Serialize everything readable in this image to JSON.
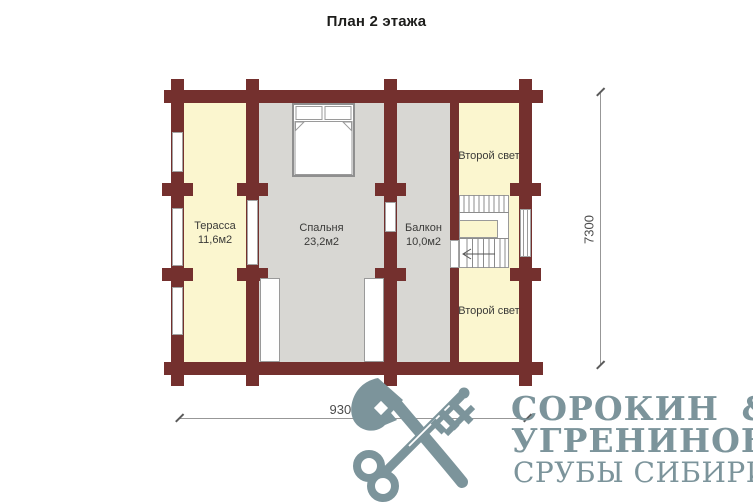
{
  "title": "План 2 этажа",
  "plan": {
    "rooms": {
      "terrace": {
        "name": "Терасса",
        "area": "11,6м2"
      },
      "bedroom": {
        "name": "Спальня",
        "area": "23,2м2"
      },
      "balcony": {
        "name": "Балкон",
        "area": "10,0м2"
      },
      "second_light_top": {
        "name": "Второй свет"
      },
      "second_light_bottom": {
        "name": "Второй свет"
      }
    },
    "dimensions": {
      "width_mm": "9300",
      "height_mm": "7300"
    }
  },
  "logo": {
    "line1": "СОРОКИН &",
    "line2": "УГРЕНИНОВ",
    "line3": "СРУБЫ СИБИРИ"
  },
  "colors": {
    "wall": "#74302e",
    "room_yellow": "#fbf6cf",
    "room_gray": "#d8d7d3",
    "logo_slate": "#7c949b"
  }
}
